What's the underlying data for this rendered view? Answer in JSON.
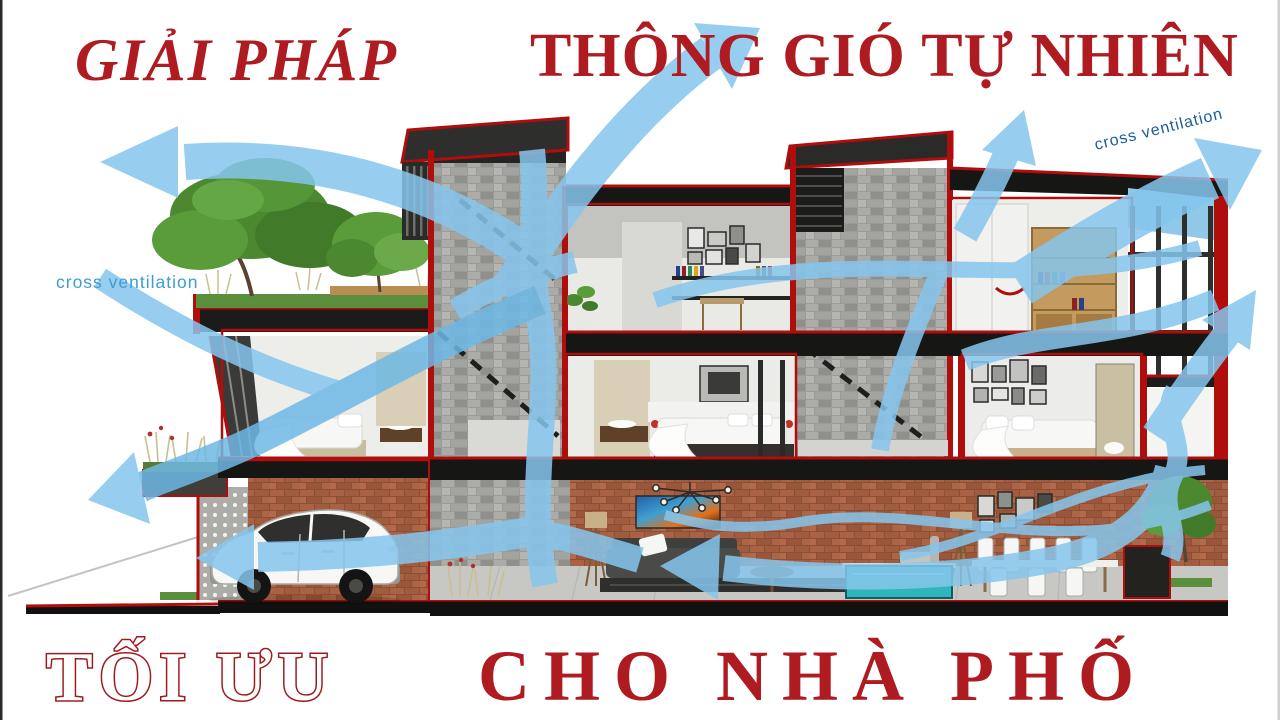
{
  "header": {
    "left": "GIẢI PHÁP",
    "right": "THÔNG GIÓ TỰ NHIÊN"
  },
  "footer": {
    "left": "TỐI ƯU",
    "right": "CHO NHÀ PHỐ"
  },
  "annotations": {
    "cross_ventilation_left": "cross ventilation",
    "cross_ventilation_right": "cross ventilation"
  },
  "colors": {
    "title_red": "#AE1B21",
    "outline_red": "#9E1A1F",
    "airflow_blue": "#86C6ED",
    "annotation_blue_left": "#3D9BD6",
    "annotation_blue_right": "#1A5E96",
    "structure_red": "#B00D0D",
    "slab_black": "#161614",
    "brick": "#9E5A3C",
    "stone_gray": "#A8A8A4",
    "grass_green": "#5C8F3D",
    "pool_teal": "#2FB6BC"
  },
  "diagram": {
    "type": "architecture-cross-section",
    "subject": "natural cross ventilation airflow through a multi-storey townhouse"
  }
}
